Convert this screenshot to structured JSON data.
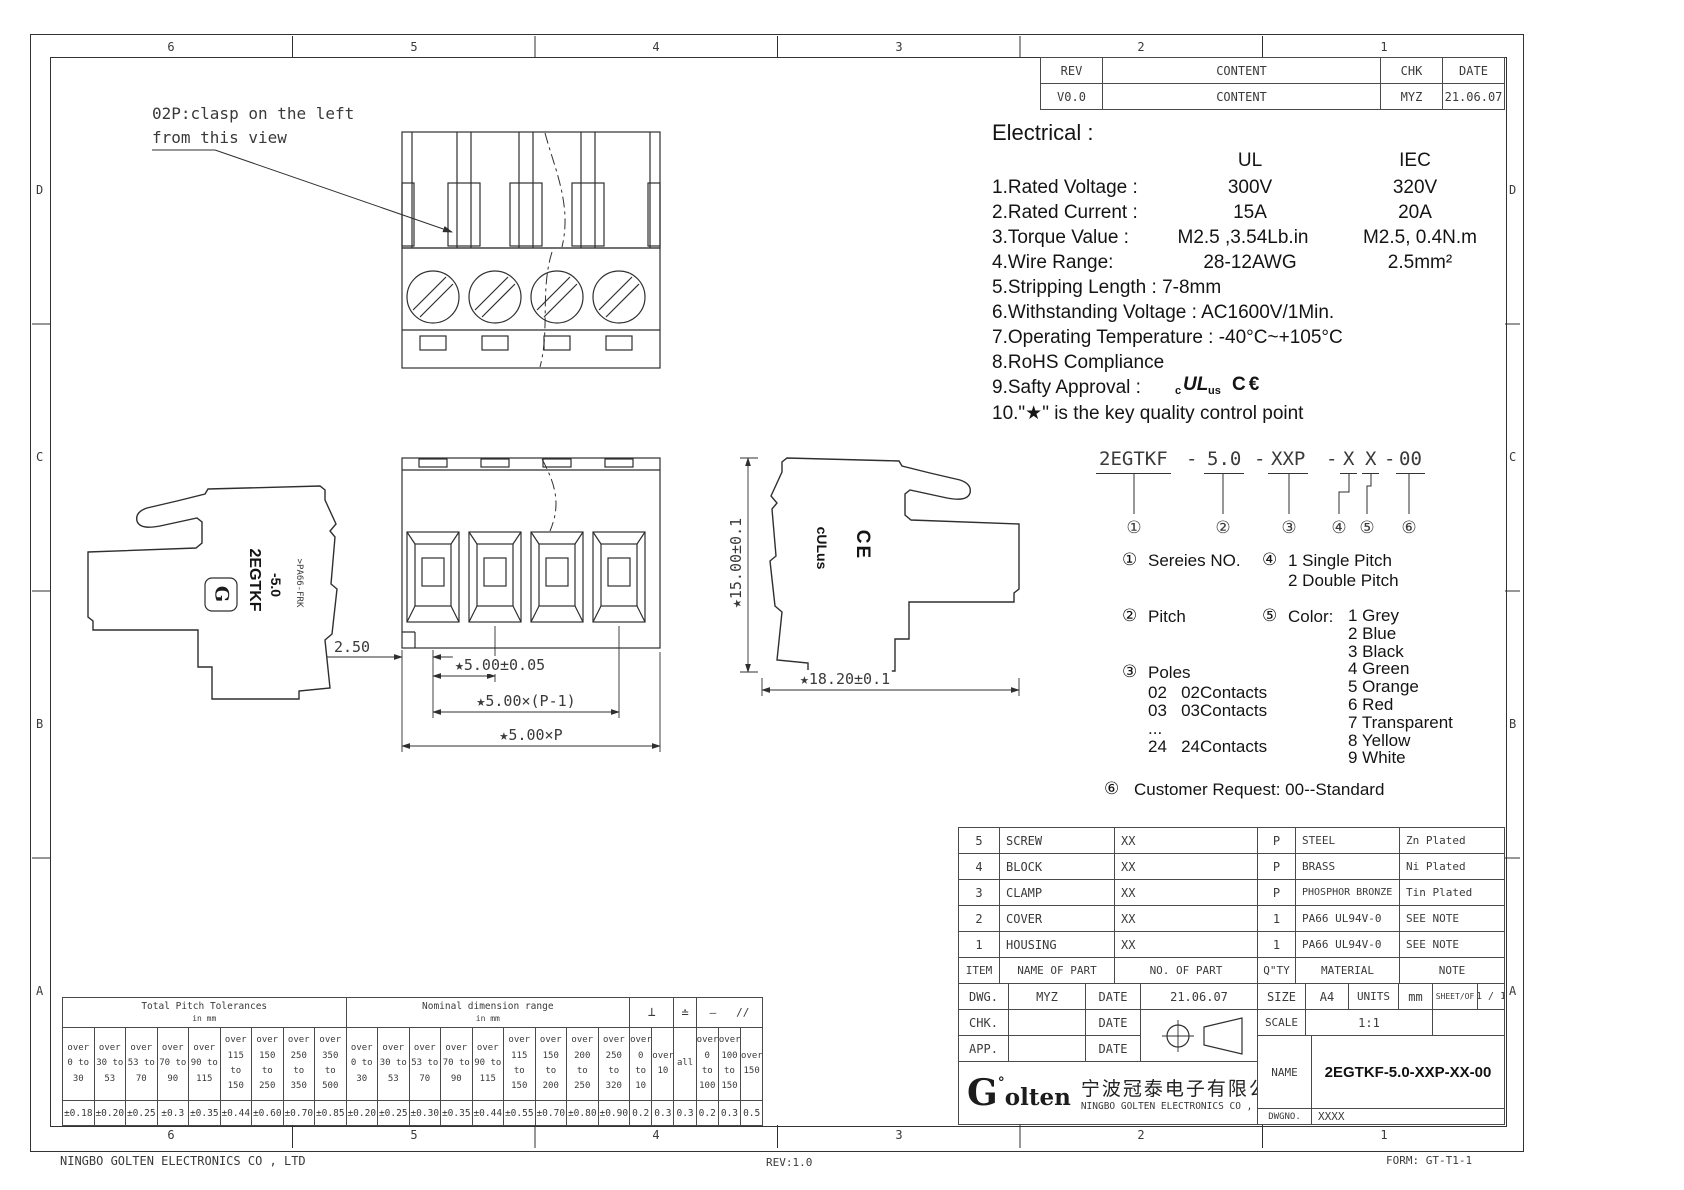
{
  "zones": {
    "cols": [
      "6",
      "5",
      "4",
      "3",
      "2",
      "1"
    ],
    "rows": [
      "D",
      "C",
      "B",
      "A"
    ]
  },
  "footer": {
    "company": "NINGBO GOLTEN ELECTRONICS CO , LTD",
    "rev": "REV:1.0",
    "form": "FORM: GT-T1-1"
  },
  "revision": {
    "headers": [
      "REV",
      "CONTENT",
      "CHK",
      "DATE"
    ],
    "row": [
      "V0.0",
      "CONTENT",
      "MYZ",
      "21.06.07"
    ]
  },
  "electrical": {
    "title": "Electrical :",
    "col_ul": "UL",
    "col_iec": "IEC",
    "rows": [
      {
        "label": "1.Rated Voltage :",
        "ul": "300V",
        "iec": "320V"
      },
      {
        "label": "2.Rated Current :",
        "ul": "15A",
        "iec": "20A"
      },
      {
        "label": "3.Torque Value :",
        "ul": "M2.5 ,3.54Lb.in",
        "iec": "M2.5, 0.4N.m"
      },
      {
        "label": "4.Wire Range:",
        "ul": "28-12AWG",
        "iec": "2.5mm²"
      }
    ],
    "lines": [
      "5.Stripping Length : 7-8mm",
      "6.Withstanding Voltage : AC1600V/1Min.",
      "7.Operating Temperature : -40°C~+105°C",
      "8.RoHS Compliance"
    ],
    "line9_label": "9.Safty Approval :",
    "approval": {
      "c": "c",
      "ul": "UL",
      "us": "us",
      "ce": "C€"
    },
    "line10": "10.\"★\" is the key quality control point"
  },
  "ordering": {
    "s1": "2EGTKF",
    "s2": "5.0",
    "s3": "XXP",
    "s4": "X",
    "s5": "X",
    "s6": "00",
    "dash": "-",
    "marks": [
      "①",
      "②",
      "③",
      "④",
      "⑤",
      "⑥"
    ]
  },
  "legend": {
    "s1": {
      "mark": "①",
      "label": "Sereies NO."
    },
    "s2": {
      "mark": "②",
      "label": "Pitch"
    },
    "s3": {
      "mark": "③",
      "label": "Poles",
      "items": [
        "02   02Contacts",
        "03   03Contacts",
        "...",
        "24   24Contacts"
      ]
    },
    "s4": {
      "mark": "④",
      "items": [
        "1   Single Pitch",
        "2   Double Pitch"
      ]
    },
    "s5": {
      "mark": "⑤",
      "label": "Color:",
      "items": [
        "1 Grey",
        "2 Blue",
        "3 Black",
        "4 Green",
        "5 Orange",
        "6 Red",
        "7 Transparent",
        "8 Yellow",
        "9 White"
      ]
    },
    "s6": {
      "mark": "⑥",
      "label": "Customer Request: 00--Standard"
    }
  },
  "bom": {
    "headers": [
      "ITEM",
      "NAME  OF  PART",
      "NO. OF  PART",
      "Q\"TY",
      "MATERIAL",
      "NOTE"
    ],
    "rows": [
      [
        "5",
        "SCREW",
        "XX",
        "P",
        "STEEL",
        "Zn Plated"
      ],
      [
        "4",
        "BLOCK",
        "XX",
        "P",
        "BRASS",
        "Ni Plated"
      ],
      [
        "3",
        "CLAMP",
        "XX",
        "P",
        "PHOSPHOR BRONZE",
        "Tin Plated"
      ],
      [
        "2",
        "COVER",
        "XX",
        "1",
        "PA66 UL94V-0",
        "SEE NOTE"
      ],
      [
        "1",
        "HOUSING",
        "XX",
        "1",
        "PA66 UL94V-0",
        "SEE NOTE"
      ]
    ]
  },
  "title_block": {
    "dwg_label": "DWG.",
    "dwg_value": "MYZ",
    "date_label": "DATE",
    "dwg_date": "21.06.07",
    "chk_label": "CHK.",
    "app_label": "APP.",
    "size_label": "SIZE",
    "size_value": "A4",
    "units_label": "UNITS",
    "units_value": "mm",
    "sheet_label": "SHEET/OF",
    "sheet_value": "1 / 1",
    "scale_label": "SCALE",
    "scale_value": "1:1",
    "name_label": "NAME",
    "name_value": "2EGTKF-5.0-XXP-XX-00",
    "dwgno_label": "DWGNO.",
    "dwgno_value": "XXXX",
    "logo_g": "G",
    "logo_deg": "°",
    "logo_rest": "olten",
    "company_cn": "宁波冠泰电子有限公司",
    "company_en": "NINGBO GOLTEN ELECTRONICS CO , LTD"
  },
  "tolerance": {
    "pitch": {
      "title": "Total Pitch Tolerances",
      "subtitle": "in mm",
      "cols": [
        {
          "lines": [
            "over",
            "0",
            "to",
            "30"
          ],
          "val": "±0.18"
        },
        {
          "lines": [
            "over",
            "30",
            "to",
            "53"
          ],
          "val": "±0.20"
        },
        {
          "lines": [
            "over",
            "53",
            "to",
            "70"
          ],
          "val": "±0.25"
        },
        {
          "lines": [
            "over",
            "70",
            "to",
            "90"
          ],
          "val": "±0.3"
        },
        {
          "lines": [
            "over",
            "90",
            "to",
            "115"
          ],
          "val": "±0.35"
        },
        {
          "lines": [
            "over",
            "115",
            "to",
            "150"
          ],
          "val": "±0.44"
        },
        {
          "lines": [
            "over",
            "150",
            "to",
            "250"
          ],
          "val": "±0.60"
        },
        {
          "lines": [
            "over",
            "250",
            "to",
            "350"
          ],
          "val": "±0.70"
        },
        {
          "lines": [
            "over",
            "350",
            "to",
            "500"
          ],
          "val": "±0.85"
        }
      ]
    },
    "nominal": {
      "title": "Nominal dimension range",
      "subtitle": "in mm",
      "cols": [
        {
          "lines": [
            "over",
            "0",
            "to",
            "30"
          ],
          "val": "±0.20"
        },
        {
          "lines": [
            "over",
            "30",
            "to",
            "53"
          ],
          "val": "±0.25"
        },
        {
          "lines": [
            "over",
            "53",
            "to",
            "70"
          ],
          "val": "±0.30"
        },
        {
          "lines": [
            "over",
            "70",
            "to",
            "90"
          ],
          "val": "±0.35"
        },
        {
          "lines": [
            "over",
            "90",
            "to",
            "115"
          ],
          "val": "±0.44"
        },
        {
          "lines": [
            "over",
            "115",
            "to",
            "150"
          ],
          "val": "±0.55"
        },
        {
          "lines": [
            "over",
            "150",
            "to",
            "200"
          ],
          "val": "±0.70"
        },
        {
          "lines": [
            "over",
            "200",
            "to",
            "250"
          ],
          "val": "±0.80"
        },
        {
          "lines": [
            "over",
            "250",
            "to",
            "320"
          ],
          "val": "±0.90"
        }
      ]
    },
    "geo": {
      "perp": "⊥",
      "flat": "≐",
      "line": "—",
      "par": "//",
      "cols": [
        {
          "lines": [
            "over",
            "0",
            "to",
            "10"
          ],
          "val": "0.2"
        },
        {
          "lines": [
            "over",
            "10"
          ],
          "val": "0.3"
        },
        {
          "lines": [
            "all"
          ],
          "val": "0.3"
        },
        {
          "lines": [
            "over",
            "0",
            "to",
            "100"
          ],
          "val": "0.2"
        },
        {
          "lines": [
            "over",
            "100",
            "to",
            "150"
          ],
          "val": "0.3"
        },
        {
          "lines": [
            "over",
            "150"
          ],
          "val": "0.5"
        }
      ]
    }
  },
  "annotations": {
    "note_line1": "02P:clasp on the left",
    "note_line2": "from this view",
    "dim_step": "2.50",
    "dim_pitch": "★5.00±0.05",
    "dim_pitch_pm1": "★5.00×(P-1)",
    "dim_pitch_total": "★5.00×P",
    "dim_height": "★15.00±0.1",
    "dim_depth": "★18.20±0.1",
    "part_marking_1": "2EGTKF",
    "part_marking_2": "-5.0",
    "material_marking": ">PA66-FRK",
    "logo_mark": "G",
    "ul_mark": "cULus",
    "ce_mark": "CE"
  }
}
